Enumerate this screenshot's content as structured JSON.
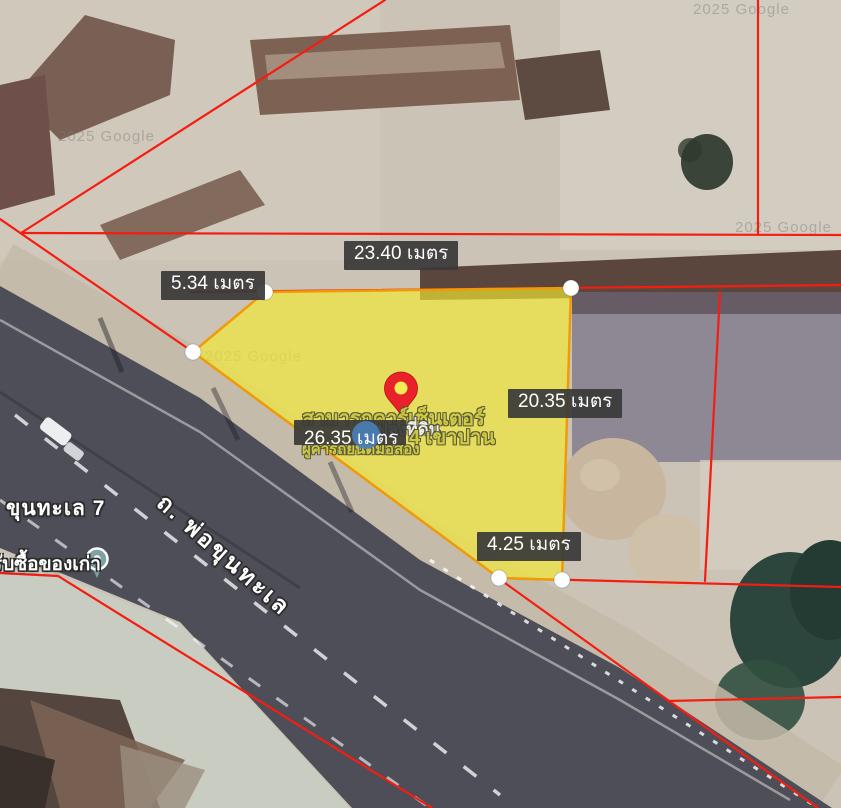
{
  "view": {
    "type": "satellite-map-land-plot-measurement"
  },
  "colors": {
    "boundary_red": "#f51d12",
    "plot_fill": "#f4e932",
    "plot_stroke": "#f09b05",
    "label_bg": "#383838",
    "label_text": "#ffffff",
    "pin_red": "#e8212a",
    "road": "#4e4e58"
  },
  "measurements": [
    {
      "label": "23.40 เมตร"
    },
    {
      "label": "5.34 เมตร"
    },
    {
      "label": "20.35 เมตร"
    },
    {
      "label": "26.35 เมตร"
    },
    {
      "label": "4.25 เมตร"
    }
  ],
  "street_labels": {
    "road_name": "ถ. พ่อขุนทะเล",
    "soi": "ขุนทะเล 7",
    "shop": "รับซื้อของเก่า"
  },
  "overlay_watermark": {
    "line1": "สามารถคาร์เซ็นเตอร์",
    "line2": "แปลงที่ดิน",
    "line3": "4 เขาปาน",
    "line4": "ผู้ค้ารถยนต์มือสอง"
  },
  "map_watermarks": [
    {
      "text": "2025 Google"
    },
    {
      "text": "2025 Google"
    },
    {
      "text": "2025 Google"
    },
    {
      "text": "2025 Google"
    }
  ]
}
